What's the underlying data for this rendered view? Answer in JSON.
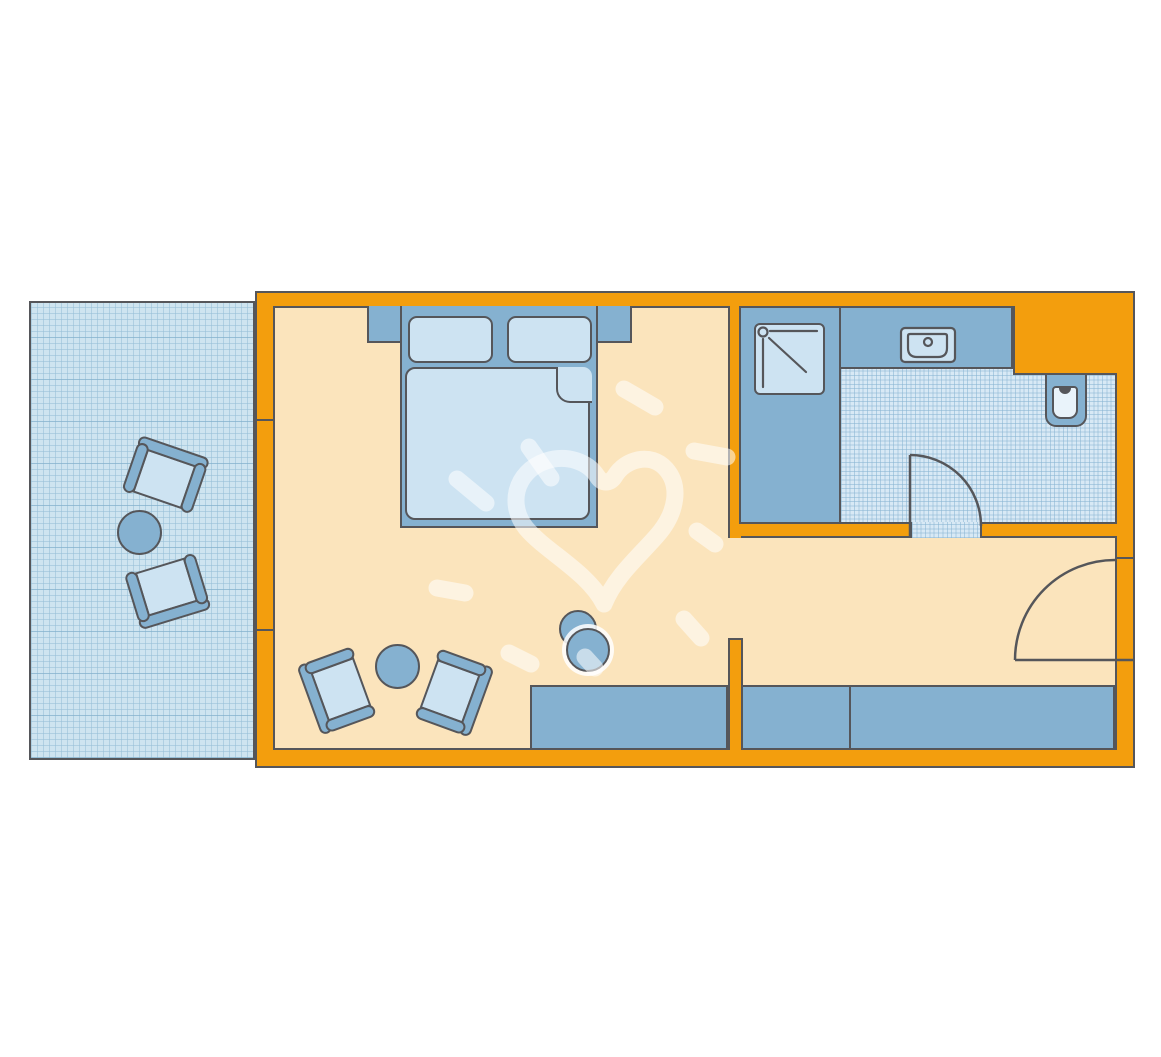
{
  "diagram": {
    "type": "floor-plan",
    "title": "Hotel room floor plan",
    "rooms": [
      {
        "name": "terrace",
        "floor": "grid-paving"
      },
      {
        "name": "bedroom-living-room",
        "floor": "plain"
      },
      {
        "name": "bathroom",
        "floor": "tiles"
      }
    ],
    "furniture": [
      "double-bed-with-two-pillows",
      "nightstand-left",
      "nightstand-right",
      "armchair-room-left",
      "armchair-room-right",
      "round-table-room",
      "floor-lamp",
      "wardrobe-left",
      "wardrobe-right",
      "terrace-chair-top",
      "terrace-chair-bottom",
      "round-table-terrace"
    ],
    "fixtures": [
      "shower",
      "washbasin-on-counter",
      "toilet",
      "bathroom-door",
      "entrance-door",
      "terrace-window-opening"
    ],
    "palette": {
      "wall_orange": "#F39E0D",
      "outline_gray": "#55565A",
      "furniture_blue": "#85B1D0",
      "furniture_light_blue": "#CDE3F2",
      "fixture_pale_blue": "#E9F3FA",
      "floor_cream": "#FBE4BC",
      "tile_blue": "#D8E9F5",
      "terrace_blue": "#CEE4F0",
      "watermark": "rgba(255,255,255,0.55)"
    }
  }
}
